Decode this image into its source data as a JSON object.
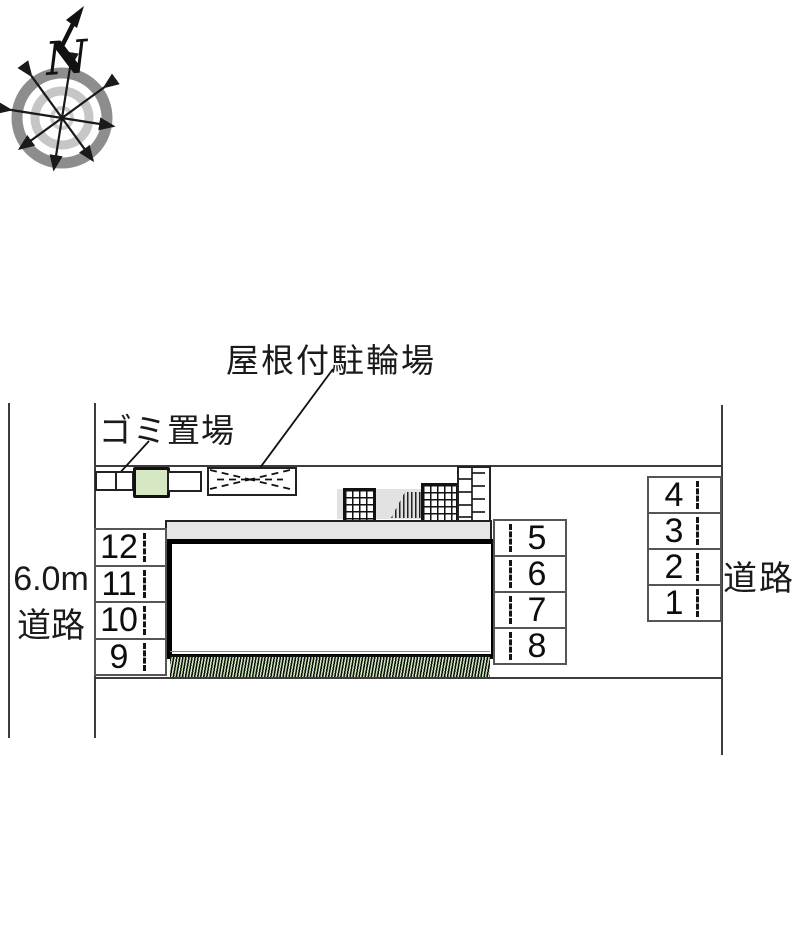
{
  "compass": {
    "north_label": "N"
  },
  "labels": {
    "covered_bicycle_parking": "屋根付駐輪場",
    "garbage_area": "ゴミ置場",
    "west_road_width": "6.0m",
    "west_road": "道路",
    "east_road": "道路"
  },
  "parking": {
    "west_column": {
      "spaces": [
        "12",
        "11",
        "10",
        "9"
      ]
    },
    "center_column": {
      "spaces": [
        "5",
        "6",
        "7",
        "8"
      ]
    },
    "east_column": {
      "spaces": [
        "4",
        "3",
        "2",
        "1"
      ]
    }
  },
  "colors": {
    "accent_green": "#d5e8c3",
    "hedge_green": "#c9e2b4",
    "building_band_gray": "#e6e6e6",
    "walkway_gray": "#e2e2e2",
    "line_dark": "#1a1a1a",
    "stall_border_gray": "#555555",
    "compass_outer_ring": "#8d8d8d",
    "compass_inner_ring": "#c6c6c6"
  }
}
